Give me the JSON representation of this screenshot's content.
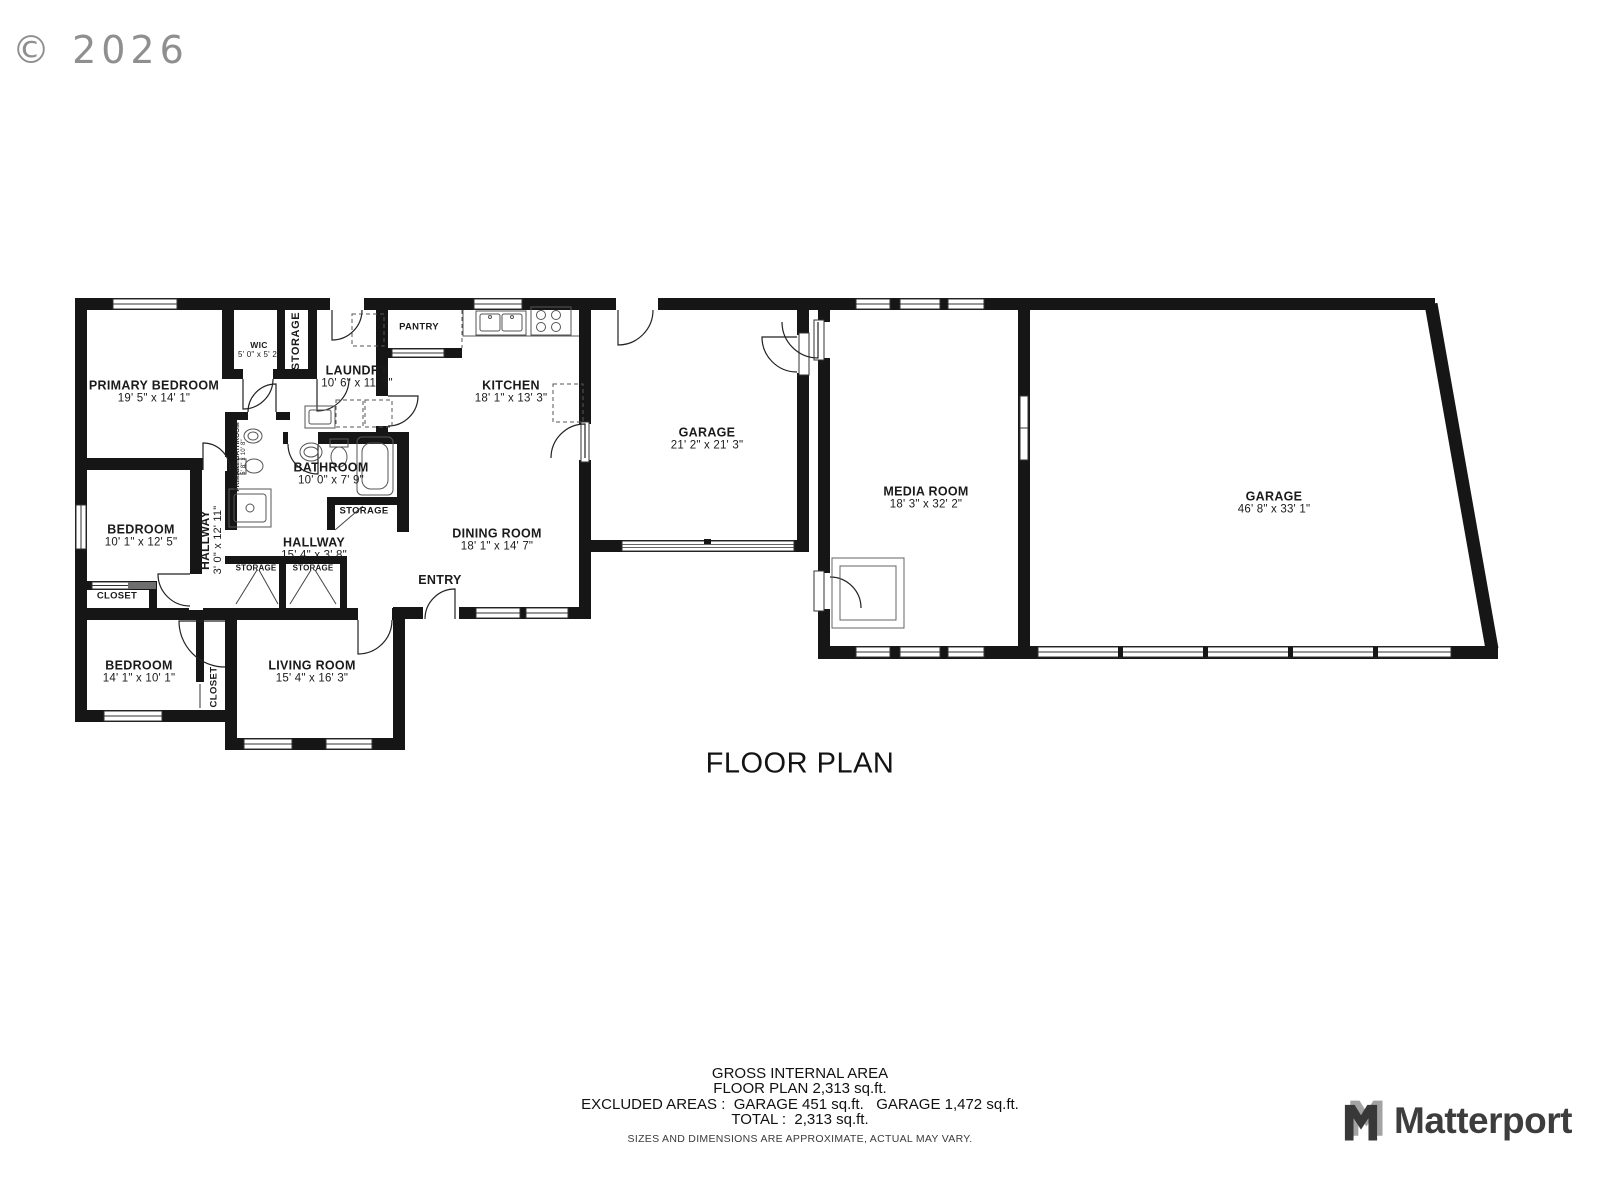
{
  "copyright": "© 2026",
  "plan_title": "FLOOR PLAN",
  "rooms": {
    "primary_bedroom": {
      "name": "PRIMARY BEDROOM",
      "dims": "19' 5\" x 14' 1\""
    },
    "wic": {
      "name": "WIC",
      "dims": "5' 0\" x 5' 2\""
    },
    "storage_upper": {
      "name": "STORAGE"
    },
    "laundry": {
      "name": "LAUNDRY",
      "dims": "10' 6\" x 11' 5\""
    },
    "pantry": {
      "name": "PANTRY"
    },
    "kitchen": {
      "name": "KITCHEN",
      "dims": "18' 1\" x 13' 3\""
    },
    "garage_small": {
      "name": "GARAGE",
      "dims": "21' 2\" x 21' 3\""
    },
    "media_room": {
      "name": "MEDIA ROOM",
      "dims": "18' 3\" x 32' 2\""
    },
    "garage_large": {
      "name": "GARAGE",
      "dims": "46' 8\" x 33' 1\""
    },
    "primary_bathroom": {
      "name": "PRIMARY BATHROOM",
      "dims": "5' 8\" x 10' 8\""
    },
    "bathroom": {
      "name": "BATHROOM",
      "dims": "10' 0\" x 7' 9\""
    },
    "storage_bath": {
      "name": "STORAGE"
    },
    "hallway_long": {
      "name": "HALLWAY",
      "dims": "3' 0\" x 12' 11\""
    },
    "bedroom_middle": {
      "name": "BEDROOM",
      "dims": "10' 1\" x 12' 5\""
    },
    "closet_middle": {
      "name": "CLOSET"
    },
    "hallway_short": {
      "name": "HALLWAY",
      "dims": "15' 4\" x 3' 8\""
    },
    "storage_hall_left": {
      "name": "STORAGE"
    },
    "storage_hall_right": {
      "name": "STORAGE"
    },
    "dining_room": {
      "name": "DINING ROOM",
      "dims": "18' 1\" x 14' 7\""
    },
    "entry": {
      "name": "ENTRY"
    },
    "bedroom_lower": {
      "name": "BEDROOM",
      "dims": "14' 1\" x 10' 1\""
    },
    "closet_lower": {
      "name": "CLOSET"
    },
    "living_room": {
      "name": "LIVING ROOM",
      "dims": "15' 4\" x 16' 3\""
    }
  },
  "footer": {
    "gross_title": "GROSS INTERNAL AREA",
    "floor_plan_area": "FLOOR PLAN 2,313 sq.ft.",
    "excluded_areas": "EXCLUDED AREAS :  GARAGE 451 sq.ft.   GARAGE 1,472 sq.ft.",
    "total": "TOTAL :  2,313 sq.ft.",
    "disclaimer": "SIZES AND DIMENSIONS ARE APPROXIMATE, ACTUAL MAY VARY."
  },
  "brand": {
    "name": "Matterport"
  }
}
